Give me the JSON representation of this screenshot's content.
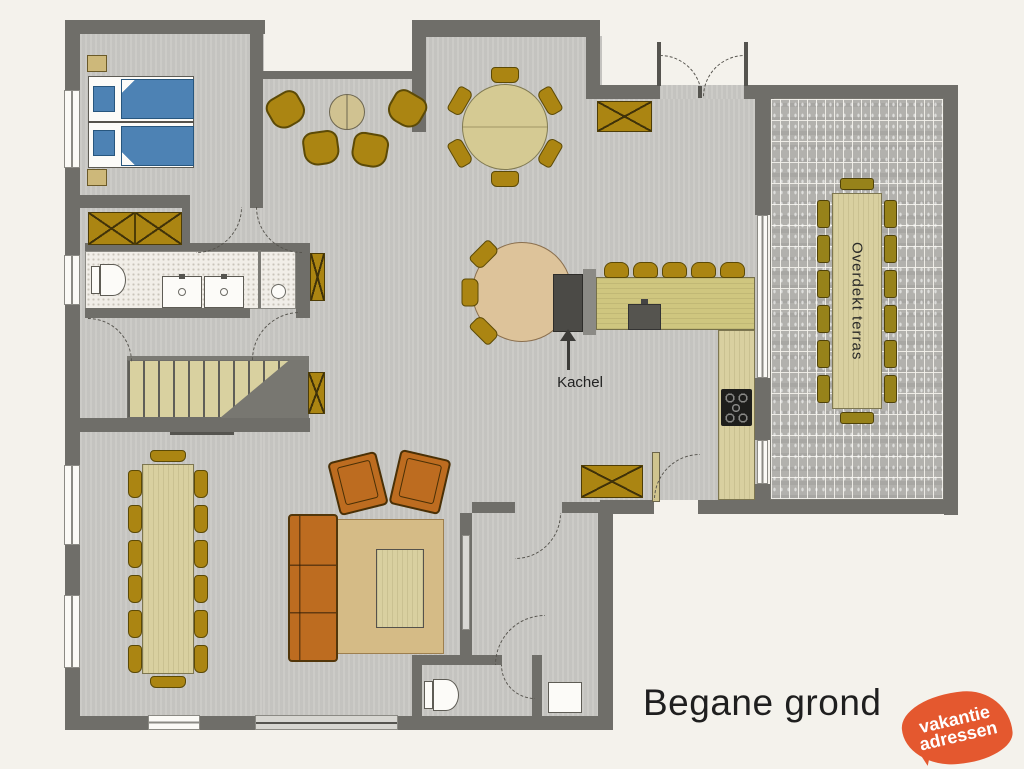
{
  "title": "Begane grond",
  "labels": {
    "kachel": "Kachel",
    "terrace": "Overdekt terras"
  },
  "logo": {
    "line1": "vakantie",
    "line2": "adressen"
  },
  "colors": {
    "paper": "#f4f2ec",
    "floor_gray": "#c9c8c4",
    "wall_dark": "#6f6e69",
    "furniture_gold": "#ab8512",
    "wood_light": "#d9d0a0",
    "sofa_orange": "#bd6c20",
    "bed_blue": "#4d82b4",
    "rug_beige": "#d5bb86",
    "terrace_brick": "#b2b1ad",
    "logo_orange": "#e4582f"
  }
}
